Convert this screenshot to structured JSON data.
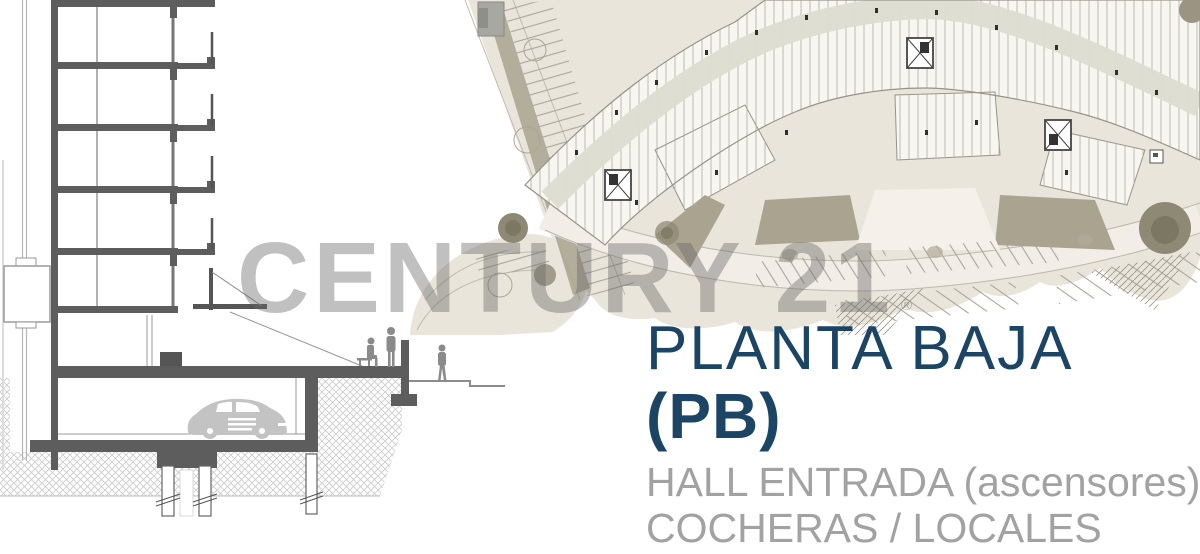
{
  "canvas": {
    "width": 1200,
    "height": 554,
    "background": "#ffffff"
  },
  "watermark": {
    "text": "CENTURY 21",
    "registered_mark": "®"
  },
  "title_block": {
    "title": "PLANTA BAJA",
    "code": "(PB)",
    "feature_line_1": "HALL ENTRADA (ascensores)",
    "feature_line_2": "COCHERAS / LOCALES",
    "description": "Acceso y salida directo por dos calles diferentes. Cocheras propias con baulera"
  },
  "colors": {
    "title_navy": "#1c4565",
    "feature_gray": "#a2a2a2",
    "description_gray": "#58585a",
    "watermark_gray": "rgba(104,104,104,0.42)",
    "plan_ground_beige": "#eae5db",
    "plan_road_light": "#f2ede7",
    "plan_building_units": "#f7f6f1",
    "plan_circulation_sage": "#dcddd0",
    "plan_olive_accent": "#a9a390",
    "plan_tree_olive": "#8e8974",
    "section_dark_gray": "#5d5d5d",
    "section_line_gray": "#8c8c8c",
    "section_car_gray": "#c3c3c3"
  }
}
